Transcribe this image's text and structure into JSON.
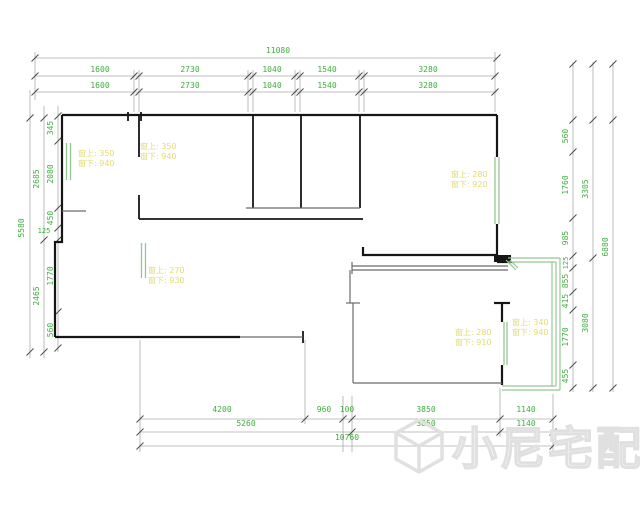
{
  "drawing": {
    "type": "apartment floor plan",
    "colors": {
      "wall": "#161616",
      "interior_wall": "#6a6a6a",
      "dimension_line": "#aaaaaa",
      "dimension_text": "#3eae3e",
      "window": "#95c795",
      "label_text": "#e4da6e",
      "watermark": "#e0e0e0"
    }
  },
  "dims": {
    "top": {
      "total": "11080",
      "row1": [
        "1600",
        "2730",
        "1040",
        "1540",
        "3280"
      ],
      "row2": [
        "1600",
        "2730",
        "1040",
        "1540",
        "3280"
      ]
    },
    "bottom": {
      "row1": [
        "4200",
        "960",
        "100",
        "3850",
        "1140"
      ],
      "row2": [
        "5260",
        "3850",
        "1140"
      ],
      "total": "10760"
    },
    "left": {
      "outer": "5580",
      "mid": [
        "2685",
        "2465"
      ],
      "inner": [
        "345",
        "2080",
        "450",
        "1770",
        "560"
      ],
      "small": "125"
    },
    "right": {
      "outer": "6880",
      "mid": [
        "3305",
        "3080"
      ],
      "inner": [
        "560",
        "1760",
        "985",
        "125",
        "855",
        "415",
        "1770",
        "455"
      ]
    }
  },
  "window_labels": [
    {
      "top": "窗上: 350",
      "bottom": "窗下: 940"
    },
    {
      "top": "窗上: 350",
      "bottom": "窗下: 940"
    },
    {
      "top": "窗上: 280",
      "bottom": "窗下: 920"
    },
    {
      "top": "窗上: 270",
      "bottom": "窗下: 930"
    },
    {
      "top": "窗上: 280",
      "bottom": "窗下: 910"
    },
    {
      "top": "窗上: 340",
      "bottom": "窗下: 940"
    }
  ],
  "watermark": {
    "text": "小尼宅配",
    "logo": "cube-logo"
  }
}
